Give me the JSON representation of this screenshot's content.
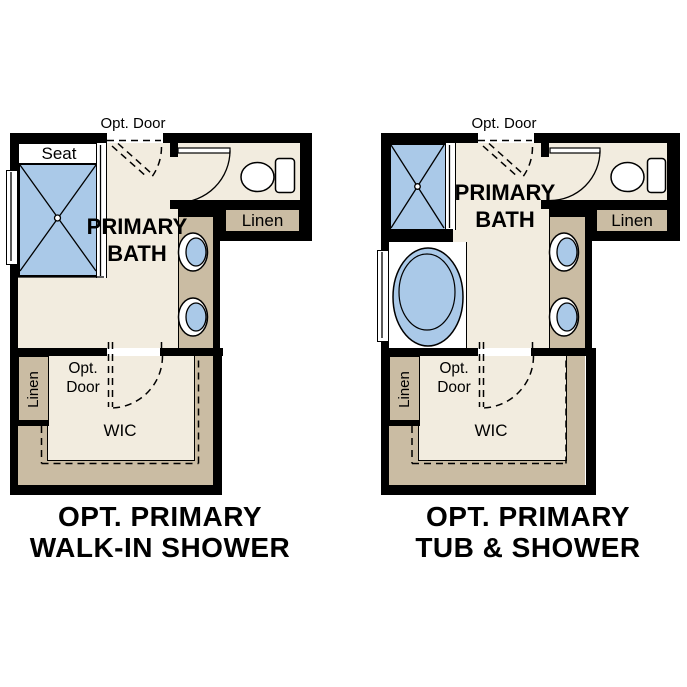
{
  "plans": [
    {
      "name": "walk-in-shower",
      "title": {
        "line1": "OPT. PRIMARY",
        "line2": "WALK-IN SHOWER"
      },
      "labels": {
        "opt_door_top": "Opt. Door",
        "seat": "Seat",
        "room_line1": "PRIMARY",
        "room_line2": "BATH",
        "linen_top": "Linen",
        "linen_side": "Linen",
        "wic_door_line1": "Opt.",
        "wic_door_line2": "Door",
        "wic": "WIC"
      }
    },
    {
      "name": "tub-shower",
      "title": {
        "line1": "OPT. PRIMARY",
        "line2": "TUB & SHOWER"
      },
      "labels": {
        "opt_door_top": "Opt. Door",
        "room_line1": "PRIMARY",
        "room_line2": "BATH",
        "linen_top": "Linen",
        "linen_side": "Linen",
        "wic_door_line1": "Opt.",
        "wic_door_line2": "Door",
        "wic": "WIC"
      }
    }
  ],
  "colors": {
    "wall": "#000000",
    "floor_cream": "#f2ecdf",
    "cabinet_tan": "#cabca3",
    "fixture_blue": "#aac9e8",
    "background": "#ffffff",
    "text": "#000000"
  }
}
